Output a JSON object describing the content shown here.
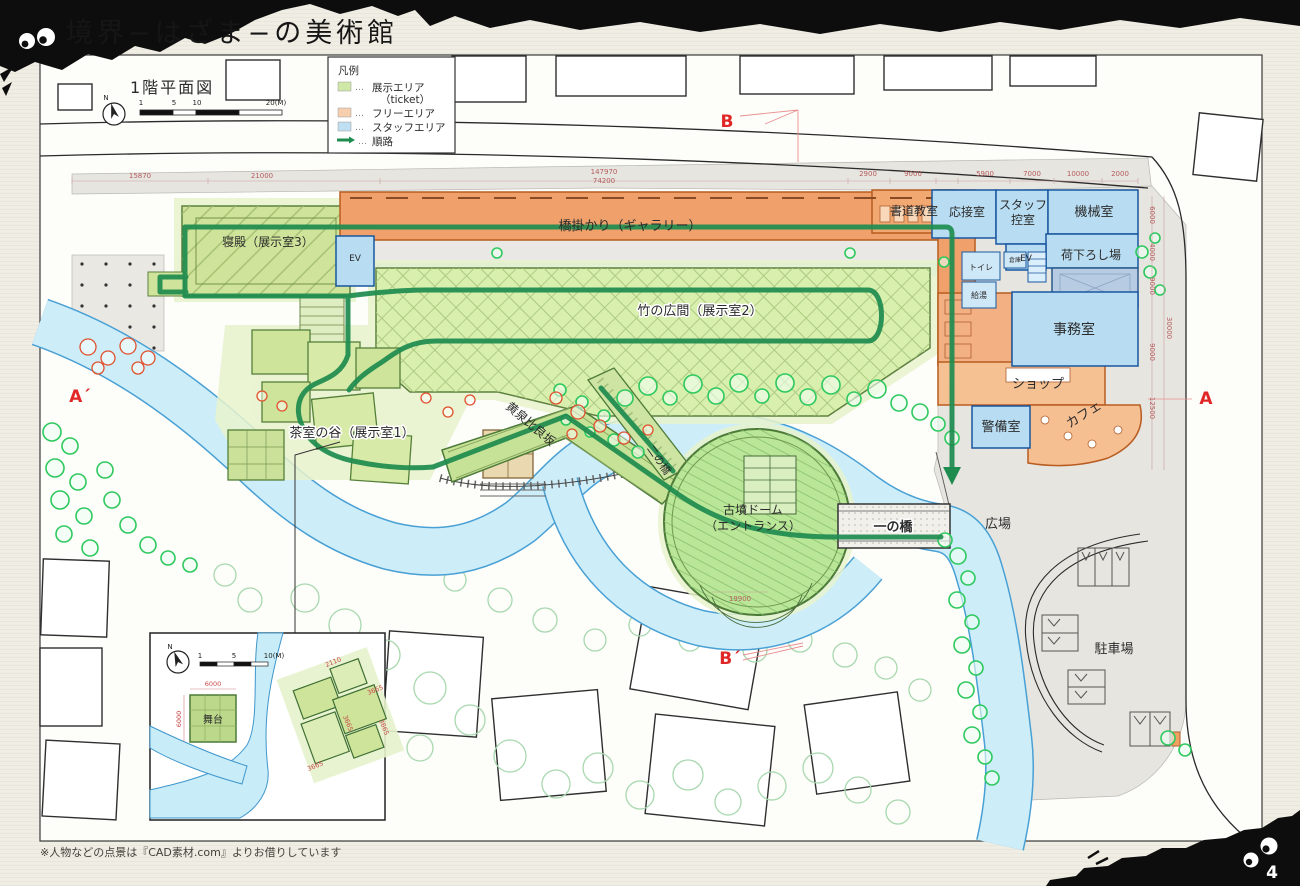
{
  "header": {
    "title": "境界−はざま−の美術館"
  },
  "page": {
    "number": "4",
    "note": "※人物などの点景は『CAD素材.com』よりお借りしています"
  },
  "colors": {
    "route": "#1e8c4f",
    "exhibit": "#cfe8a8",
    "free": "#f8cfae",
    "staff": "#bfe0f2",
    "marker": "#e02626"
  },
  "plan": {
    "title": "1階平面図",
    "north": "N",
    "scale": [
      "1",
      "5",
      "10",
      "20(M)"
    ]
  },
  "legend": {
    "title": "凡例",
    "dots": "…",
    "items": [
      {
        "label": "展示エリア",
        "label2": "（ticket）",
        "color": "#cfe8a8"
      },
      {
        "label": "フリーエリア",
        "color": "#f8cfae"
      },
      {
        "label": "スタッフエリア",
        "color": "#bfe0f2"
      },
      {
        "label": "順路",
        "color": "#1e8c4f"
      }
    ]
  },
  "rooms": {
    "shinden": "寝殿（展示室3）",
    "gallery": "橋掛かり（ギャラリー）",
    "take_hiroma": "竹の広間（展示室2）",
    "chashitsu": "茶室の谷（展示室1）",
    "yomotsu_hirasaka": "黄泉比良坂",
    "ni_no_hashi": "二の橋",
    "kofun_dome_1": "古墳ドーム",
    "kofun_dome_2": "（エントランス）",
    "ichi_no_hashi": "一の橋",
    "hiroba": "広場",
    "chushajo": "駐車場",
    "shodo": "書道教室",
    "osetsu": "応接室",
    "staff_hikae_1": "スタッフ",
    "staff_hikae_2": "控室",
    "kikai": "機械室",
    "ev": "EV",
    "nioroshi": "荷下ろし場",
    "toilet": "トイレ",
    "kyuto": "給湯",
    "souko": "倉庫",
    "jimusho": "事務室",
    "shop": "ショップ",
    "cafe": "カフェ",
    "keibi": "警備室"
  },
  "markers": {
    "b": "B",
    "b_prime": "B´",
    "a_prime": "A´",
    "a": "A"
  },
  "dims": {
    "top": [
      "15870",
      "21000",
      "147970",
      "74200",
      "2900",
      "9000",
      "5900",
      "7000",
      "10000",
      "2000"
    ],
    "right": [
      "6000",
      "4000",
      "9000",
      "30000",
      "9000",
      "12500"
    ],
    "misc": [
      "19900"
    ]
  },
  "inset": {
    "north": "N",
    "scale": [
      "1",
      "5",
      "10(M)"
    ],
    "stage_label": "舞台",
    "dims": [
      "6000",
      "6000",
      "2110",
      "3665",
      "3665",
      "3665",
      "3665"
    ]
  }
}
